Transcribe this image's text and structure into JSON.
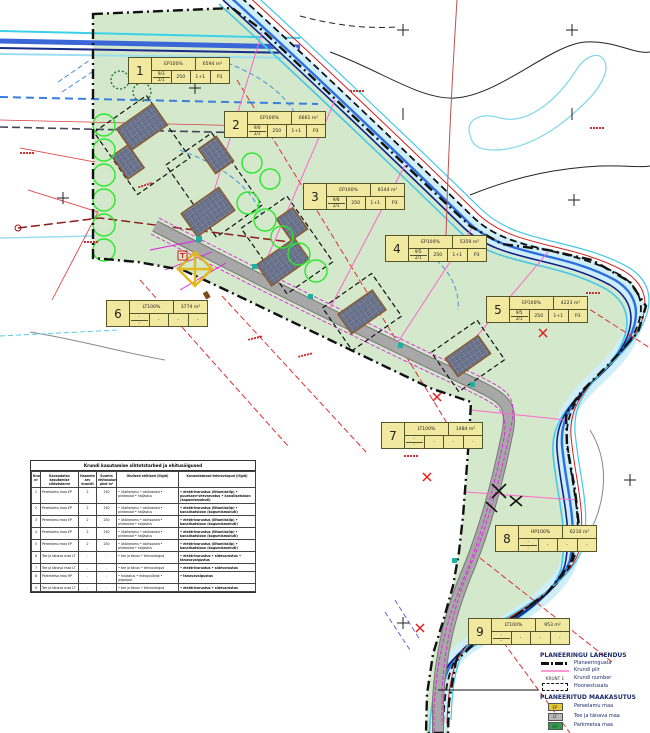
{
  "map": {
    "plots": [
      {
        "nr": "1",
        "use": "EP100%",
        "area": "6594 m²",
        "fracTop": "9/3",
        "fracBot": "2/1",
        "c2": "250",
        "c3": "1+1",
        "c4": "P1"
      },
      {
        "nr": "2",
        "use": "EP100%",
        "area": "6661 m²",
        "fracTop": "9/0",
        "fracBot": "2/1",
        "c2": "250",
        "c3": "1+1",
        "c4": "P3"
      },
      {
        "nr": "3",
        "use": "EP100%",
        "area": "8144 m²",
        "fracTop": "9/8",
        "fracBot": "2/1",
        "c2": "250",
        "c3": "1+1",
        "c4": "P3"
      },
      {
        "nr": "4",
        "use": "EP100%",
        "area": "5359 m²",
        "fracTop": "9/5",
        "fracBot": "2/1",
        "c2": "250",
        "c3": "1+1",
        "c4": "P3"
      },
      {
        "nr": "5",
        "use": "EP100%",
        "area": "4223 m²",
        "fracTop": "9/5",
        "fracBot": "2/1",
        "c2": "250",
        "c3": "1+1",
        "c4": "P3"
      },
      {
        "nr": "6",
        "use": "LT100%",
        "area": "3774 m²",
        "fracTop": "-",
        "fracBot": "-",
        "c2": "-",
        "c3": "-",
        "c4": "-"
      },
      {
        "nr": "7",
        "use": "LT100%",
        "area": "1484 m²",
        "fracTop": "-",
        "fracBot": "-",
        "c2": "-",
        "c3": "-",
        "c4": "-"
      },
      {
        "nr": "8",
        "use": "HP100%",
        "area": "6210 m²",
        "fracTop": "-",
        "fracBot": "-",
        "c2": "-",
        "c3": "-",
        "c4": "-"
      },
      {
        "nr": "9",
        "use": "LT100%",
        "area": "953 m²",
        "fracTop": "-",
        "fracBot": "-",
        "c2": "-",
        "c3": "-",
        "c4": "-"
      }
    ]
  },
  "table": {
    "title": "Krundi kasutamise sihtotstarbed ja ehitusõigused",
    "headers": [
      "Krundi nr",
      "Kavandatav kasutamise sihtotstarve",
      "Hoonete arv krundil",
      "Suurim ehitusalune pind m²",
      "Olulised ehitised (liigid)",
      "Kavandatavad tehnovõrgud (liigid)"
    ],
    "rows": [
      {
        "nr": "1",
        "use": "Pereelamu maa EP",
        "count": "2",
        "pind": "250",
        "buildings": "• üksikelamu • abihooned • piirdeaiad • haljastus",
        "networks": "• elektrivarustus (liitumiskilp) • puurkaev-veevarustus • kanalisatsioon (kogumismahuti)"
      },
      {
        "nr": "2",
        "use": "Pereelamu maa EP",
        "count": "2",
        "pind": "250",
        "buildings": "• üksikelamu • abihooned • piirdeaiad • haljastus",
        "networks": "• elektrivarustus (liitumiskilp) • kanalisatsioon (kogumismahuti)"
      },
      {
        "nr": "3",
        "use": "Pereelamu maa EP",
        "count": "2",
        "pind": "250",
        "buildings": "• üksikelamu • abihooned • piirdeaiad • haljastus",
        "networks": "• elektrivarustus (liitumiskilp) • kanalisatsioon (kogumismahuti)"
      },
      {
        "nr": "4",
        "use": "Pereelamu maa EP",
        "count": "2",
        "pind": "250",
        "buildings": "• üksikelamu • abihooned • piirdeaiad • haljastus",
        "networks": "• elektrivarustus (liitumiskilp) • kanalisatsioon (kogumismahuti)"
      },
      {
        "nr": "5",
        "use": "Pereelamu maa EP",
        "count": "2",
        "pind": "250",
        "buildings": "• üksikelamu • abihooned • piirdeaiad • haljastus",
        "networks": "• elektrivarustus (liitumiskilp) • kanalisatsioon (kogumismahuti)"
      },
      {
        "nr": "6",
        "use": "Tee ja tänava maa LT",
        "count": "-",
        "pind": "-",
        "buildings": "• tee ja tänav • tehnovõrgud",
        "networks": "• elektrivarustus • sidevarustus • tänavavalgustus"
      },
      {
        "nr": "7",
        "use": "Tee ja tänava maa LT",
        "count": "-",
        "pind": "-",
        "buildings": "• tee ja tänav • tehnovõrgud",
        "networks": "• elektrivarustus • sidevarustus"
      },
      {
        "nr": "8",
        "use": "Parkmetsa maa HP",
        "count": "-",
        "pind": "-",
        "buildings": "• haljastus • mänguväljak • jalgrajad",
        "networks": "• tänavavalgustus"
      },
      {
        "nr": "9",
        "use": "Tee ja tänava maa LT",
        "count": "-",
        "pind": "-",
        "buildings": "• tee ja tänav • tehnovõrgud",
        "networks": "• elektrivarustus • sidevarustus"
      }
    ]
  },
  "legend": {
    "title": "PLANEERINGU LAHENDUS",
    "boundary_label": "Planeeringuala",
    "pink_label": "Krundi piir",
    "krunt_symbol": "KRUNT 1",
    "krunt_label": "Krundi number",
    "hoonestus_label": "Hoonestusala",
    "landuse_title": "PLANEERITUD MAAKASUTUS",
    "landuse": [
      {
        "code": "EP",
        "label": "Pereelamu maa",
        "color": "#e8c832"
      },
      {
        "code": "LT",
        "label": "Tee ja tänava maa",
        "color": "#b8b8b8"
      },
      {
        "code": "HP",
        "label": "Parkmetsa maa",
        "color": "#2f9e4a"
      }
    ]
  },
  "colors": {
    "planning_area_fill": "#d4e8cc",
    "stream_cyan": "#44c8e8",
    "stream_blue": "#2b6fe0",
    "stream_navy": "#12227f",
    "road_gray": "#a0a0a0",
    "utility_magenta": "#e020e0",
    "cadastral_red": "#d03030",
    "label_yellow": "#f2e9a0"
  }
}
